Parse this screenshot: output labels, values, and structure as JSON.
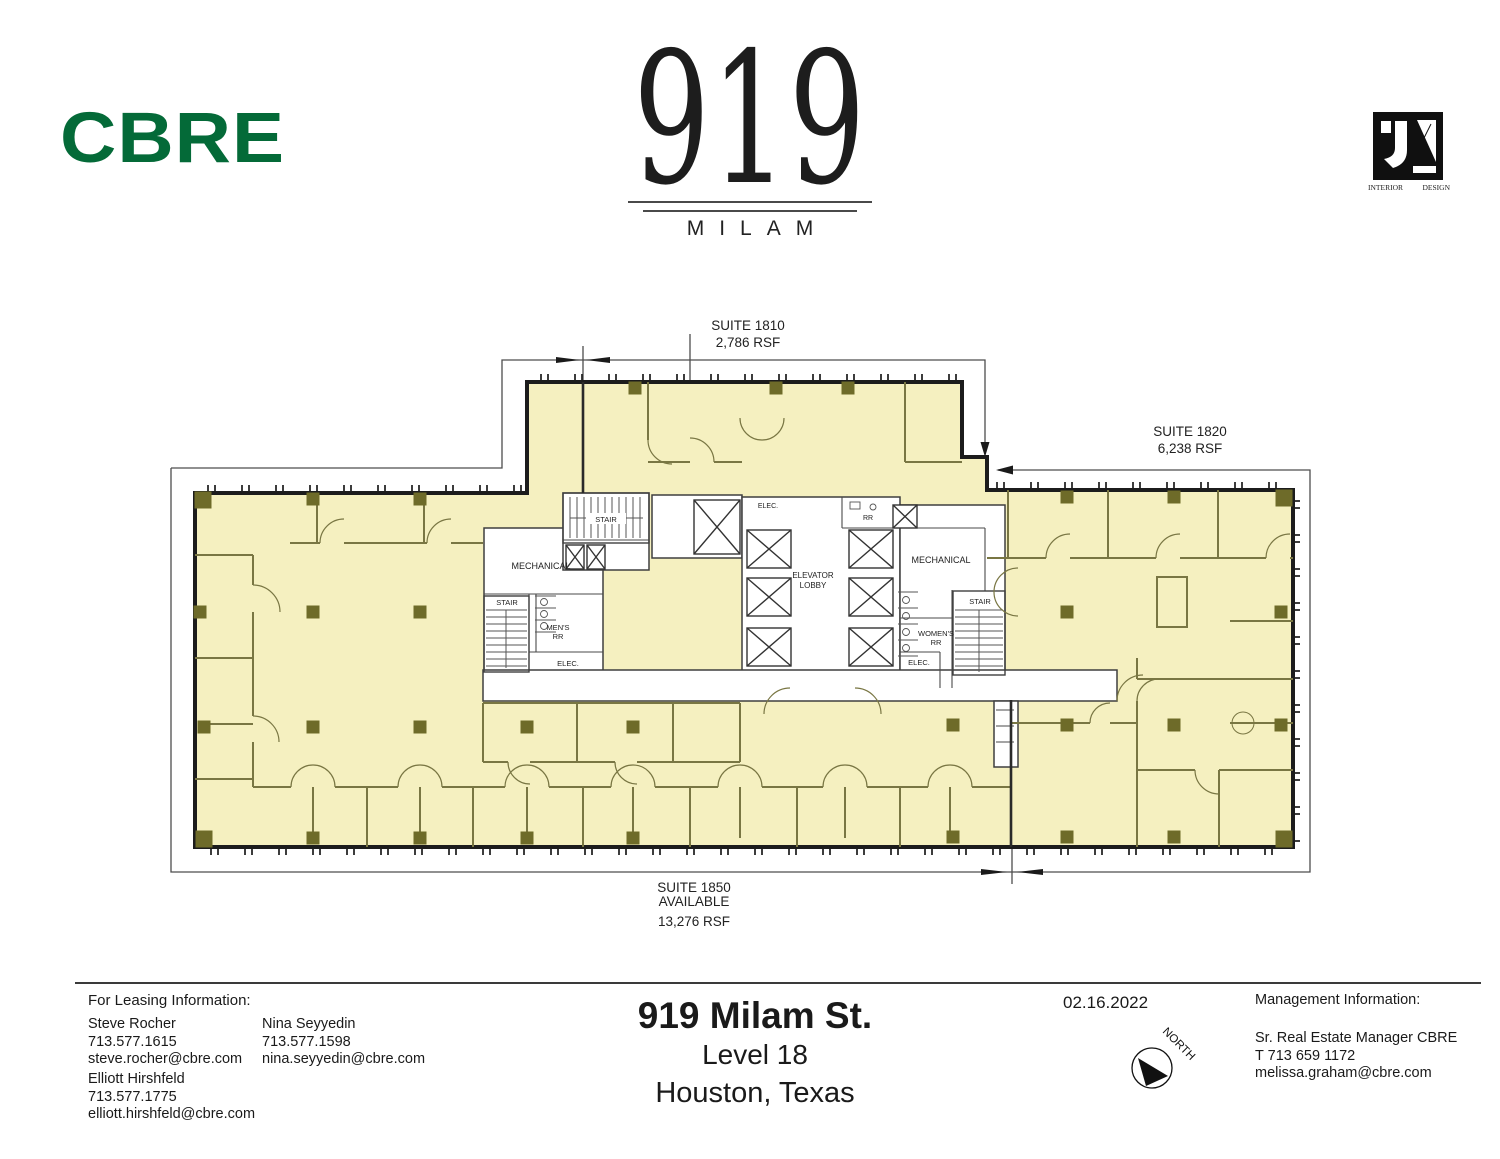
{
  "header": {
    "cbre": "CBRE",
    "building": {
      "number": "919",
      "name": "MILAM"
    },
    "jl": {
      "caption_left": "INTERIOR",
      "caption_right": "DESIGN"
    }
  },
  "plan": {
    "suites": {
      "s1810": {
        "name": "SUITE 1810",
        "rsf": "2,786 RSF"
      },
      "s1820": {
        "name": "SUITE 1820",
        "rsf": "6,238 RSF"
      },
      "s1850": {
        "name": "SUITE 1850",
        "status": "AVAILABLE",
        "rsf": "13,276 RSF"
      }
    },
    "rooms": {
      "mechanical": "MECHANICAL",
      "elevator_lobby_line1": "ELEVATOR",
      "elevator_lobby_line2": "LOBBY",
      "stair": "STAIR",
      "mens_line1": "MEN'S",
      "mens_line2": "RR",
      "womens_line1": "WOMEN'S",
      "womens_line2": "RR",
      "elec": "ELEC.",
      "rr": "RR"
    }
  },
  "footer": {
    "leasing": {
      "heading": "For Leasing Information:",
      "contacts": [
        {
          "name": "Steve Rocher",
          "phone": "713.577.1615",
          "email": "steve.rocher@cbre.com"
        },
        {
          "name": "Nina Seyyedin",
          "phone": "713.577.1598",
          "email": "nina.seyyedin@cbre.com"
        },
        {
          "name": "Elliott Hirshfeld",
          "phone": "713.577.1775",
          "email": "elliott.hirshfeld@cbre.com"
        }
      ]
    },
    "title": {
      "line1": "919 Milam St.",
      "line2": "Level 18",
      "line3": "Houston, Texas"
    },
    "date": "02.16.2022",
    "north_label": "NORTH",
    "management": {
      "heading": "Management Information:",
      "lines": [
        "Sr. Real Estate Manager CBRE",
        "T 713 659 1172",
        "melissa.graham@cbre.com"
      ]
    }
  },
  "colors": {
    "cbre_green": "#046A38",
    "suite_fill": "#F5F0C0",
    "column": "#6E6B29",
    "wall": "#1C1C1C",
    "partition": "#797643"
  }
}
